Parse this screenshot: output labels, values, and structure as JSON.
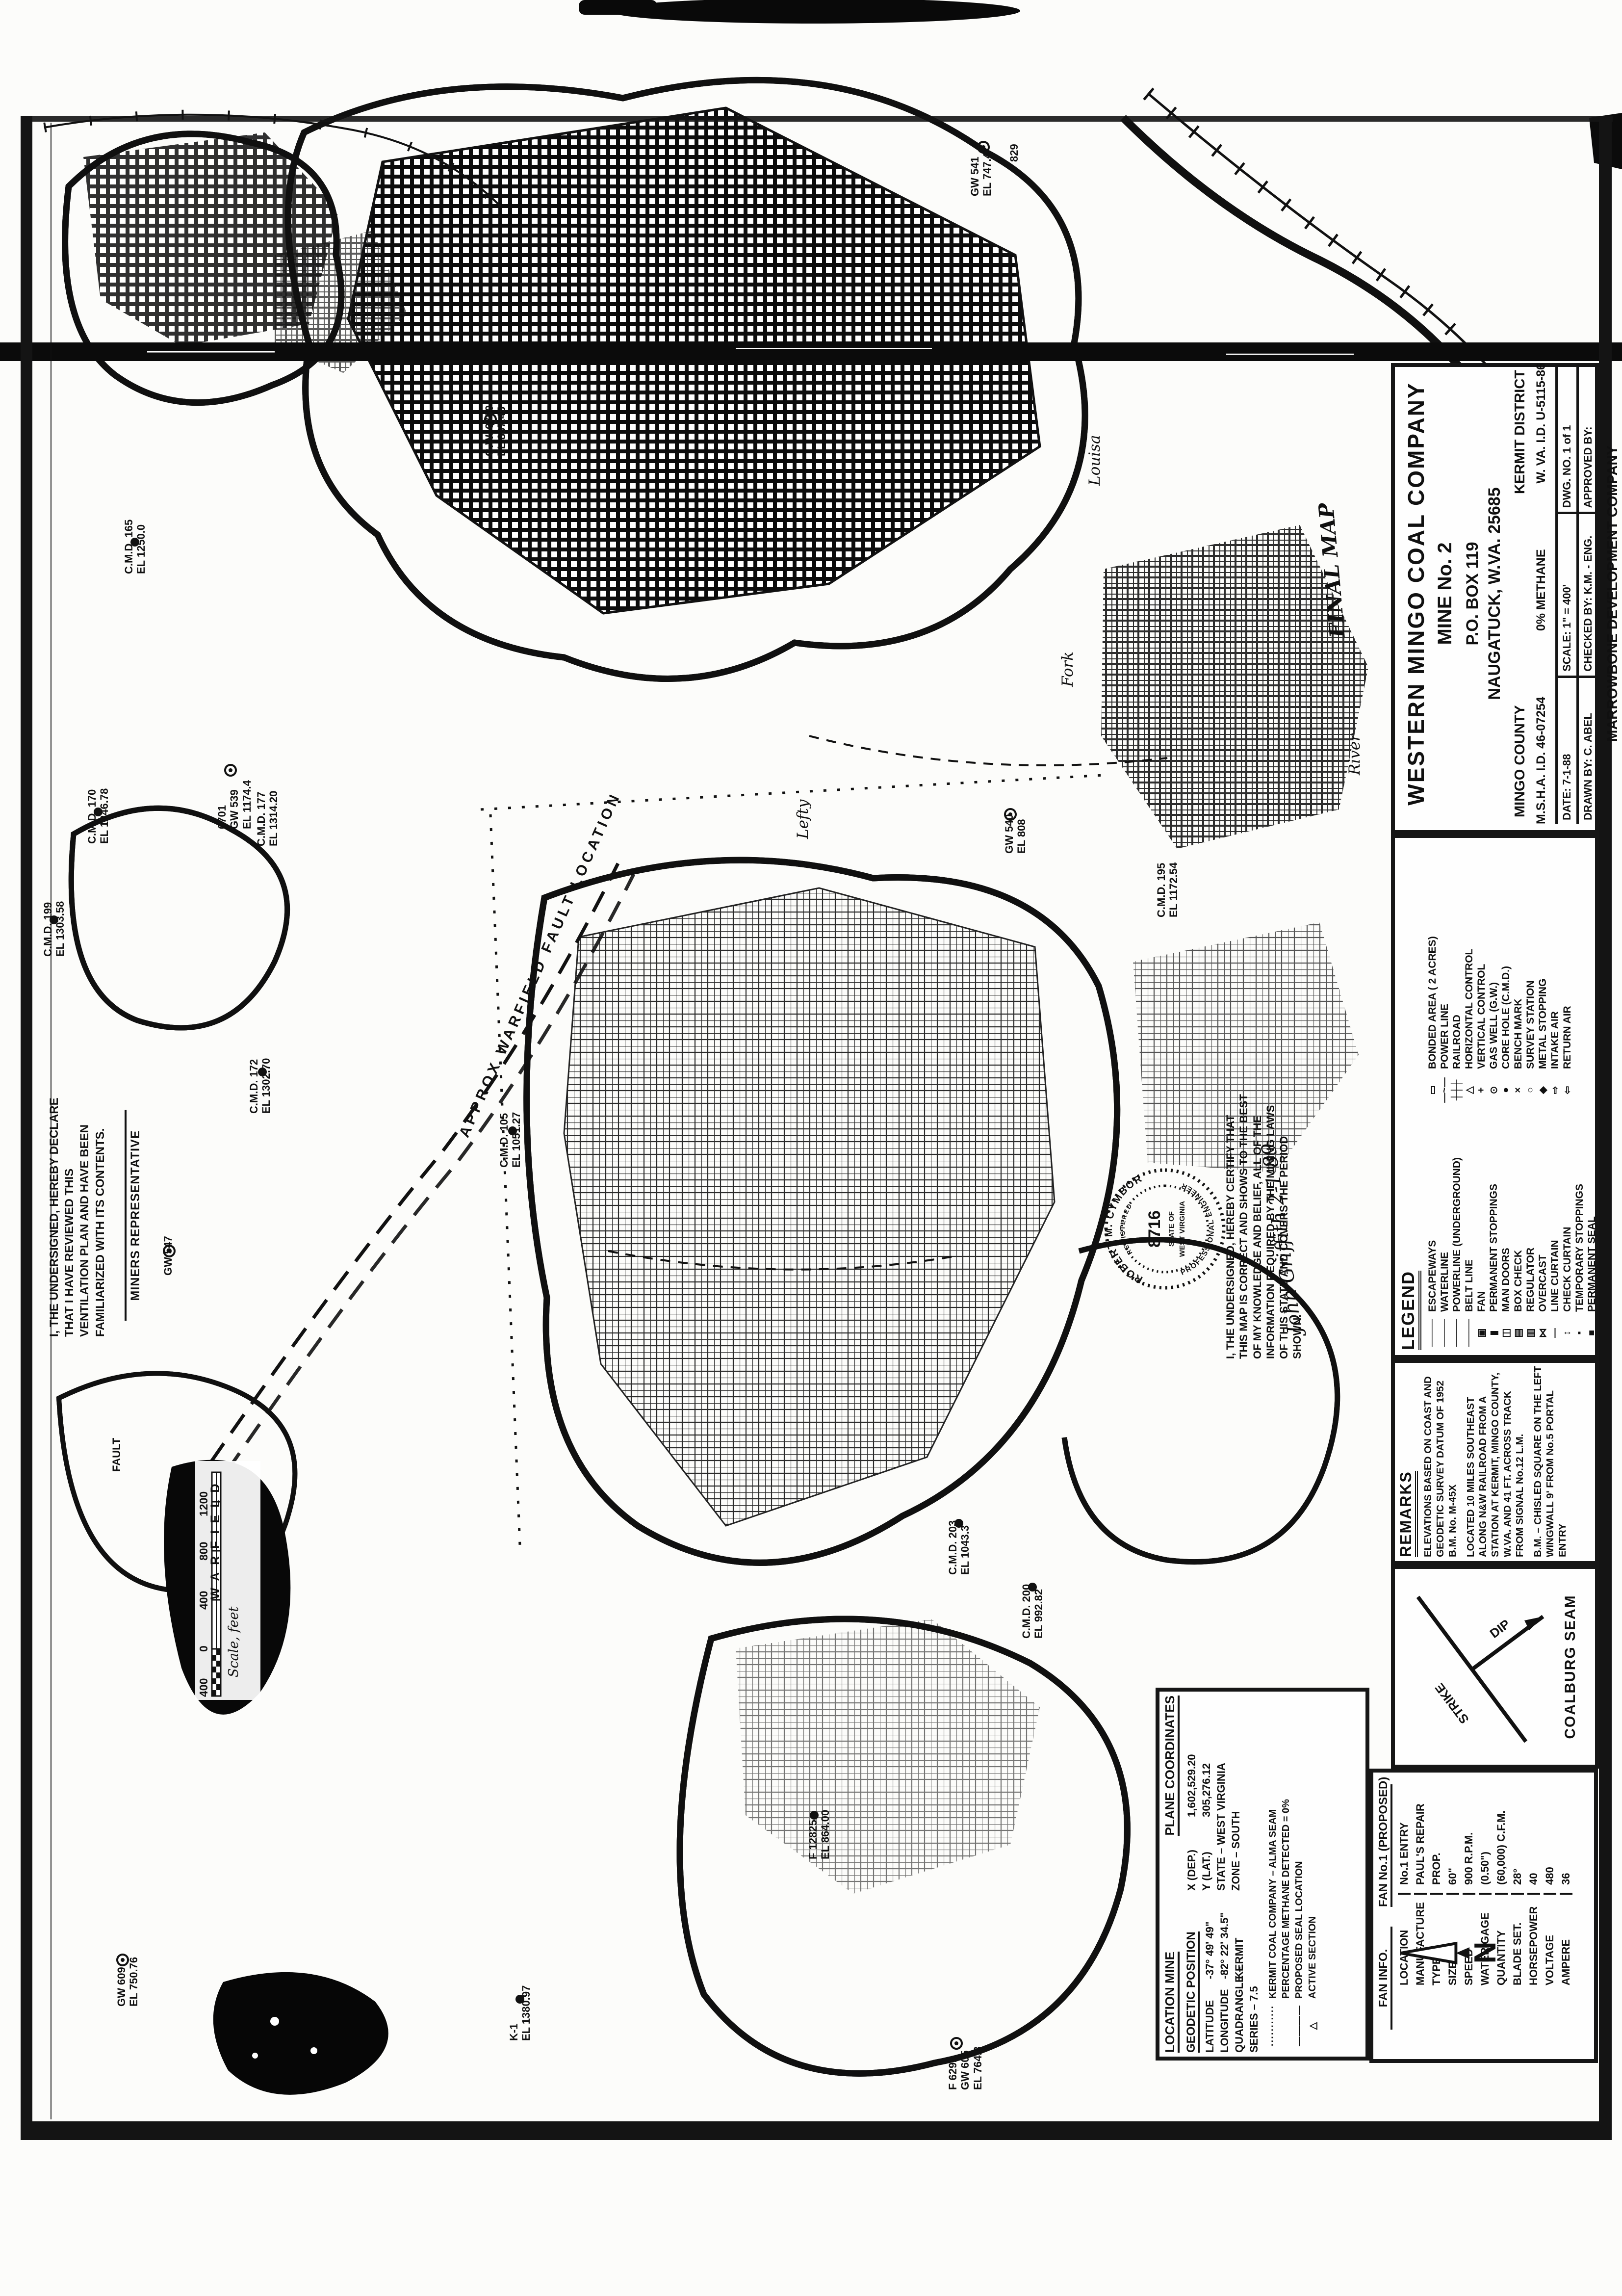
{
  "document": {
    "final_map_note": "FINAL MAP",
    "fault_label": "APPROX WARFIELD FAULT LOCATION"
  },
  "title_block": {
    "company": "WESTERN MINGO COAL COMPANY",
    "mine": "MINE No. 2",
    "po_box": "P.O. BOX 119",
    "city": "NAUGATUCK, W.VA. 25685",
    "county": "MINGO COUNTY",
    "district": "KERMIT DISTRICT",
    "msha": "M.S.H.A. I.D. 46-07254",
    "methane": "0% METHANE",
    "state_id": "W. VA. I.D. U-5115-86",
    "date_label": "DATE:",
    "date_value": "7-1-88",
    "scale_label": "SCALE:",
    "scale_value": "1\" = 400'",
    "dwg_label": "DWG. NO.",
    "dwg_value": "1 of 1",
    "drawn_label": "DRAWN BY:",
    "drawn_value": "C. ABEL",
    "checked_label": "CHECKED BY:",
    "checked_value": "K.M. - ENG.",
    "approved_label": "APPROVED BY:",
    "approved_value": "",
    "firm": "MARROWBONE DEVELOPMENT COMPANY",
    "firm_city": "NAUGATUCK, W. VA."
  },
  "legend": {
    "title": "LEGEND",
    "col_a": [
      {
        "sym": "────",
        "label": "ESCAPEWAYS"
      },
      {
        "sym": "────",
        "label": "WATERLINE"
      },
      {
        "sym": "────",
        "label": "POWERLINE (UNDERGROUND)"
      },
      {
        "sym": "────",
        "label": "BELT LINE"
      },
      {
        "sym": "▣",
        "label": "FAN"
      },
      {
        "sym": "▮",
        "label": "PERMANENT STOPPINGS"
      },
      {
        "sym": "◫",
        "label": "MAN DOORS"
      },
      {
        "sym": "▤",
        "label": "BOX CHECK"
      },
      {
        "sym": "▥",
        "label": "REGULATOR"
      },
      {
        "sym": "⋈",
        "label": "OVERCAST"
      },
      {
        "sym": "—",
        "label": "LINE CURTAIN"
      },
      {
        "sym": "↕",
        "label": "CHECK CURTAIN"
      },
      {
        "sym": "▪",
        "label": "TEMPORARY STOPPINGS"
      },
      {
        "sym": "■",
        "label": "PERMANENT SEAL"
      }
    ],
    "col_b": [
      {
        "sym": "▭",
        "label": "BONDED AREA ( 2 ACRES)"
      },
      {
        "sym": "—~—",
        "label": "POWER LINE"
      },
      {
        "sym": "┼┼┼",
        "label": "RAILROAD"
      },
      {
        "sym": "△",
        "label": "HORIZONTAL CONTROL"
      },
      {
        "sym": "+",
        "label": "VERTICAL CONTROL"
      },
      {
        "sym": "⊙",
        "label": "GAS WELL (G.W.)"
      },
      {
        "sym": "●",
        "label": "CORE HOLE (C.M.D.)"
      },
      {
        "sym": "×",
        "label": "BENCH MARK"
      },
      {
        "sym": "○",
        "label": "SURVEY STATION"
      },
      {
        "sym": "◆",
        "label": "METAL STOPPING"
      },
      {
        "sym": "⇨",
        "label": "INTAKE AIR"
      },
      {
        "sym": "⇦",
        "label": "RETURN AIR"
      }
    ]
  },
  "remarks": {
    "title": "REMARKS",
    "items": [
      "ELEVATIONS BASED ON COAST AND GEODETIC SURVEY DATUM OF 1952\nB.M. No. M-45X",
      "LOCATED 10 MILES SOUTHEAST ALONG N&W RAILROAD FROM A STATION AT KERMIT, MINGO COUNTY, W.VA. AND 41 FT. ACROSS TRACK FROM SIGNAL No.12 L.M.",
      "B.M. – CHISLED SQUARE ON THE LEFT WINGWALL 9' FROM No.5 PORTAL ENTRY"
    ]
  },
  "certification": {
    "text": "I, THE UNDERSIGNED, HEREBY CERTIFY THAT THIS MAP IS CORRECT AND SHOWS TO THE BEST OF MY KNOWLEDGE AND BELIEF, ALL OF THE INFORMATION REQUIRED BY THE MINING LAWS OF THIS STATE AND COVERS THE PERIOD SHOWN.",
    "signature": "John Griffith   2-1-89",
    "seal": {
      "name": "ROBERT M. CYMBOR",
      "registered": "REGISTERED",
      "profession": "PROFESSIONAL ENGINEER",
      "number": "8716",
      "state_line1": "STATE OF",
      "state_line2": "WEST VIRGINIA"
    }
  },
  "declaration": {
    "text": "I, THE UNDERSIGNED, HEREBY DECLARE THAT I HAVE REVIEWED THIS VENTILATION PLAN AND HAVE BEEN FAMILIARIZED WITH ITS CONTENTS.",
    "signature_label": "MINERS REPRESENTATIVE"
  },
  "seam_box": {
    "strike": "STRIKE",
    "dip": "DIP",
    "seam": "COALBURG SEAM"
  },
  "location_block": {
    "title": "LOCATION MINE",
    "plane_title": "PLANE COORDINATES",
    "x_label": "X (DEP.)",
    "x_value": "1,602,529.20",
    "y_label": "Y (LAT.)",
    "y_value": "305,276.12",
    "state": "STATE – WEST VIRGINIA",
    "zone": "ZONE – SOUTH",
    "geodetic_title": "GEODETIC POSITION",
    "lat_label": "LATITUDE",
    "lat_value": "-37° 49' 49\"",
    "lon_label": "LONGITUDE",
    "lon_value": "-82° 22' 34.5\"",
    "quad_label": "QUADRANGLE –",
    "quad_value": "KERMIT",
    "series": "SERIES – 7.5",
    "alma_sym": "···········",
    "alma_note": "KERMIT COAL COMPANY – ALMA SEAM",
    "methane_note": "PERCENTAGE METHANE DETECTED = 0%",
    "seal_sym": "————",
    "seal_note": "PROPOSED SEAL LOCATION",
    "active_sym": "△",
    "active_note": "ACTIVE SECTION"
  },
  "fan_table": {
    "header_left": "FAN INFO.",
    "header_right": "FAN No.1 (PROPOSED)",
    "rows": [
      [
        "LOCATION",
        "No.1 ENTRY"
      ],
      [
        "MANUFACTURE",
        "PAUL'S REPAIR"
      ],
      [
        "TYPE",
        "PROP."
      ],
      [
        "SIZE",
        "60\""
      ],
      [
        "SPEED",
        "900 R.P.M."
      ],
      [
        "WATER GAGE",
        "(0.50\")"
      ],
      [
        "QUANTITY",
        "(60,000) C.F.M."
      ],
      [
        "BLADE SET.",
        "28°"
      ],
      [
        "HORSEPOWER",
        "40"
      ],
      [
        "VOLTAGE",
        "480"
      ],
      [
        "AMPERE",
        "36"
      ]
    ]
  },
  "scale_bar": {
    "ticks": [
      "400",
      "0",
      "400",
      "800",
      "1200"
    ],
    "caption": "Scale, feet"
  },
  "north": {
    "label": "N"
  },
  "map_labels": [
    {
      "text": "GW 541\nEL 747.4"
    },
    {
      "text": "829"
    },
    {
      "text": "G.W. 6700\nEL 867.45"
    },
    {
      "text": "C.M.D. 165\nEL 1250.0"
    },
    {
      "text": "C.M.D. 170\nEL 1246.78"
    },
    {
      "text": "6701\nGW 539\nEL 1174.4"
    },
    {
      "text": "C.M.D. 177\nEL 1314.20"
    },
    {
      "text": "C.M.D. 199\nEL 1303.58"
    },
    {
      "text": "C.M.D. 172\nEL 1302.70"
    },
    {
      "text": "GW 547"
    },
    {
      "text": "C.M.D. 105\nEL 1051.27"
    },
    {
      "text": "GW 540\nEL 808"
    },
    {
      "text": "C.M.D. 195\nEL 1172.54"
    },
    {
      "text": "C.M.D. 200\nEL 992.82"
    },
    {
      "text": "C.M.D. 203\nEL 1043.3"
    },
    {
      "text": "F 12825\nEL 864.00"
    },
    {
      "text": "K-1\nEL 1380.97"
    },
    {
      "text": "GW 609\nEL 750.76"
    },
    {
      "text": "F 6292\nGW 605\nEL 764.3"
    },
    {
      "text": "Louisa"
    },
    {
      "text": "Fork"
    },
    {
      "text": "Lefty"
    },
    {
      "text": "River"
    },
    {
      "text": "FAULT"
    },
    {
      "text": "WARFIELD"
    }
  ]
}
